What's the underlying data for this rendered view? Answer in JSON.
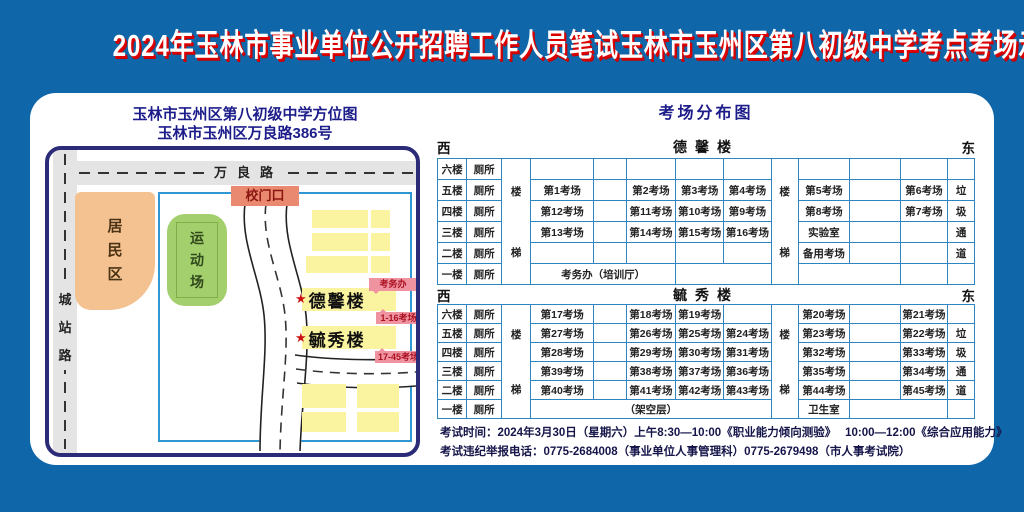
{
  "title": "2024年玉林市事业单位公开招聘工作人员笔试玉林市玉州区第八初级中学考点考场示意图",
  "map": {
    "title_line1": "玉林市玉州区第八初级中学方位图",
    "title_line2": "玉林市玉州区万良路386号",
    "roads": {
      "top": "万良路",
      "left": "城站路"
    },
    "areas": {
      "residential": "居民区",
      "sports_field": "运动场"
    },
    "gate_label": "校门口",
    "star": "★",
    "buildings": {
      "dexin": "德馨楼",
      "yuxiu": "毓秀楼"
    },
    "tags": {
      "office": "考务办",
      "rooms_1_16": "1-16考场",
      "rooms_17_45": "17-45考场"
    }
  },
  "distribution": {
    "title": "考场分布图",
    "west": "西",
    "east": "东",
    "buildings": [
      {
        "name": "德馨楼",
        "rows": [
          [
            {
              "t": "六楼"
            },
            {
              "t": "厕所"
            },
            {
              "t": "楼梯",
              "rs": 6,
              "cls": "stair"
            },
            {},
            {},
            {},
            {},
            {},
            {
              "t": "楼梯",
              "rs": 6,
              "cls": "stair"
            },
            {},
            {},
            {},
            {}
          ],
          [
            {
              "t": "五楼"
            },
            {
              "t": "厕所"
            },
            {
              "t": "第1考场"
            },
            {},
            {
              "t": "第2考场"
            },
            {
              "t": "第3考场"
            },
            {
              "t": "第4考场"
            },
            {
              "t": "第5考场"
            },
            {},
            {
              "t": "第6考场"
            },
            {
              "t": "垃"
            }
          ],
          [
            {
              "t": "四楼"
            },
            {
              "t": "厕所"
            },
            {
              "t": "第12考场"
            },
            {},
            {
              "t": "第11考场"
            },
            {
              "t": "第10考场"
            },
            {
              "t": "第9考场"
            },
            {
              "t": "第8考场"
            },
            {},
            {
              "t": "第7考场"
            },
            {
              "t": "圾"
            }
          ],
          [
            {
              "t": "三楼"
            },
            {
              "t": "厕所"
            },
            {
              "t": "第13考场"
            },
            {},
            {
              "t": "第14考场"
            },
            {
              "t": "第15考场"
            },
            {
              "t": "第16考场"
            },
            {
              "t": "实验室"
            },
            {},
            {},
            {
              "t": "通"
            }
          ],
          [
            {
              "t": "二楼"
            },
            {
              "t": "厕所"
            },
            {},
            {},
            {},
            {},
            {},
            {
              "t": "备用考场"
            },
            {},
            {},
            {
              "t": "道"
            }
          ],
          [
            {
              "t": "一楼"
            },
            {
              "t": "厕所"
            },
            {
              "t": "考务办（培训厅）",
              "cs": 3
            },
            {
              "cs": 2
            },
            {
              "cs": 2
            },
            {},
            {
              "cls": "nb"
            }
          ]
        ]
      },
      {
        "name": "毓秀楼",
        "rows": [
          [
            {
              "t": "六楼"
            },
            {
              "t": "厕所"
            },
            {
              "t": "楼梯",
              "rs": 6,
              "cls": "stair"
            },
            {
              "t": "第17考场"
            },
            {},
            {
              "t": "第18考场"
            },
            {
              "t": "第19考场"
            },
            {},
            {
              "t": "楼梯",
              "rs": 6,
              "cls": "stair"
            },
            {
              "t": "第20考场"
            },
            {},
            {
              "t": "第21考场"
            },
            {}
          ],
          [
            {
              "t": "五楼"
            },
            {
              "t": "厕所"
            },
            {
              "t": "第27考场"
            },
            {},
            {
              "t": "第26考场"
            },
            {
              "t": "第25考场"
            },
            {
              "t": "第24考场"
            },
            {
              "t": "第23考场"
            },
            {},
            {
              "t": "第22考场"
            },
            {
              "t": "垃"
            }
          ],
          [
            {
              "t": "四楼"
            },
            {
              "t": "厕所"
            },
            {
              "t": "第28考场"
            },
            {},
            {
              "t": "第29考场"
            },
            {
              "t": "第30考场"
            },
            {
              "t": "第31考场"
            },
            {
              "t": "第32考场"
            },
            {},
            {
              "t": "第33考场"
            },
            {
              "t": "圾"
            }
          ],
          [
            {
              "t": "三楼"
            },
            {
              "t": "厕所"
            },
            {
              "t": "第39考场"
            },
            {},
            {
              "t": "第38考场"
            },
            {
              "t": "第37考场"
            },
            {
              "t": "第36考场"
            },
            {
              "t": "第35考场"
            },
            {},
            {
              "t": "第34考场"
            },
            {
              "t": "通"
            }
          ],
          [
            {
              "t": "二楼"
            },
            {
              "t": "厕所"
            },
            {
              "t": "第40考场"
            },
            {},
            {
              "t": "第41考场"
            },
            {
              "t": "第42考场"
            },
            {
              "t": "第43考场"
            },
            {
              "t": "第44考场"
            },
            {},
            {
              "t": "第45考场"
            },
            {
              "t": "道"
            }
          ],
          [
            {
              "t": "一楼"
            },
            {
              "t": "厕所"
            },
            {
              "t": "（架空层）",
              "cs": 5
            },
            {
              "t": "卫生室"
            },
            {
              "cs": 2
            },
            {
              "cls": "nb"
            }
          ]
        ]
      }
    ]
  },
  "notes": {
    "line1": "考试时间：2024年3月30日（星期六）上午8:30—10:00《职业能力倾向测验》　 10:00—12:00《综合应用能力》",
    "line2": "考试违纪举报电话：0775-2684008（事业单位人事管理科）0775-2679498（市人事考试院）"
  },
  "colors": {
    "background": "#0f67a9",
    "title_text": "#ffffff",
    "title_shadow": "#dd0000",
    "heading": "#1c1c8a",
    "table_border": "#2e86c1",
    "building_fill": "#faf3a0",
    "residential_fill": "#f4c190",
    "sports_fill": "#a3d06c",
    "gate_fill": "#e98a70",
    "tag_fill": "#ef93a0"
  }
}
